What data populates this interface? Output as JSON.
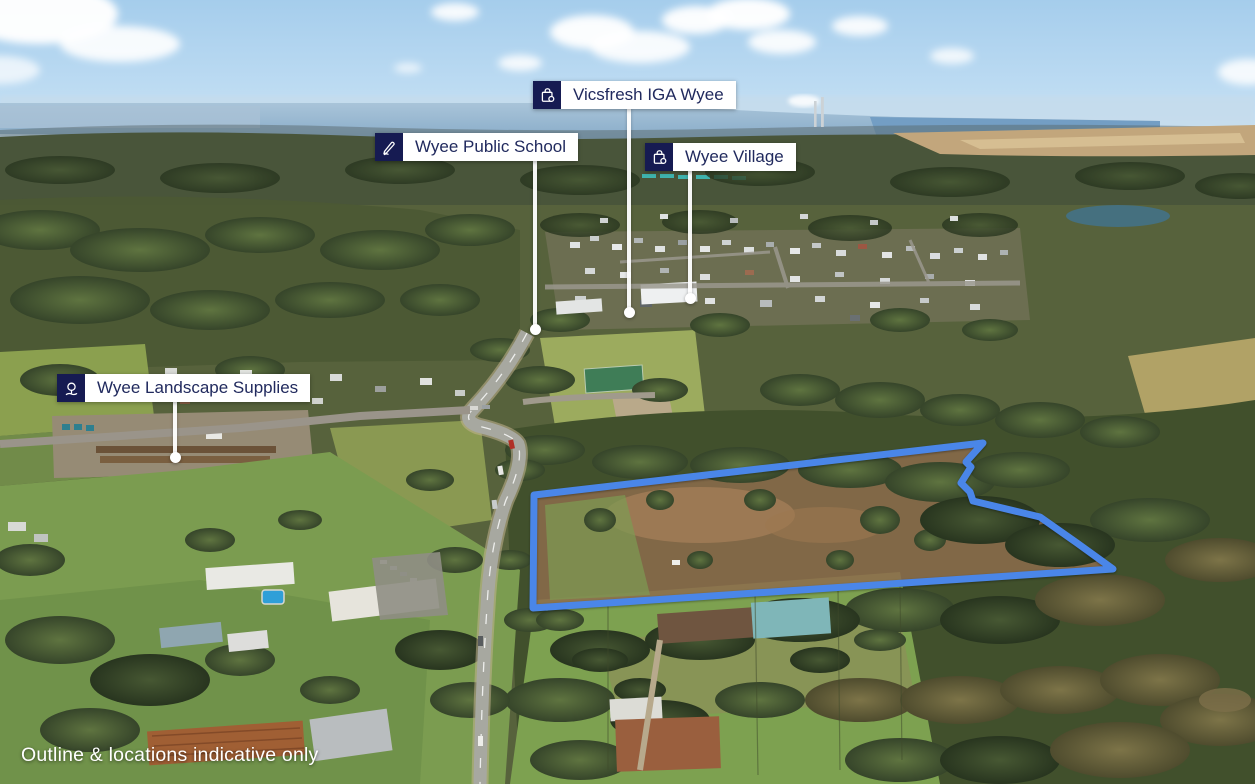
{
  "labels": {
    "iga": {
      "text": "Vicsfresh IGA Wyee",
      "icon": "shopping-bag-icon"
    },
    "school": {
      "text": "Wyee Public School",
      "icon": "pencil-icon"
    },
    "village": {
      "text": "Wyee Village",
      "icon": "shopping-bag-icon"
    },
    "landscape": {
      "text": "Wyee Landscape Supplies",
      "icon": "tree-icon"
    }
  },
  "disclaimer": "Outline & locations indicative only",
  "property_outline": {
    "color": "#4a86e8",
    "points": "534,495 983,443 966,462 971,467 961,483 970,492 973,501 1040,517 1077,543 1113,569 533,608"
  },
  "colors": {
    "label_background": "#ffffff",
    "label_text": "#212a5e",
    "icon_box_background": "#161b52",
    "leader_line": "#ffffff",
    "outline_blue": "#4a86e8"
  }
}
